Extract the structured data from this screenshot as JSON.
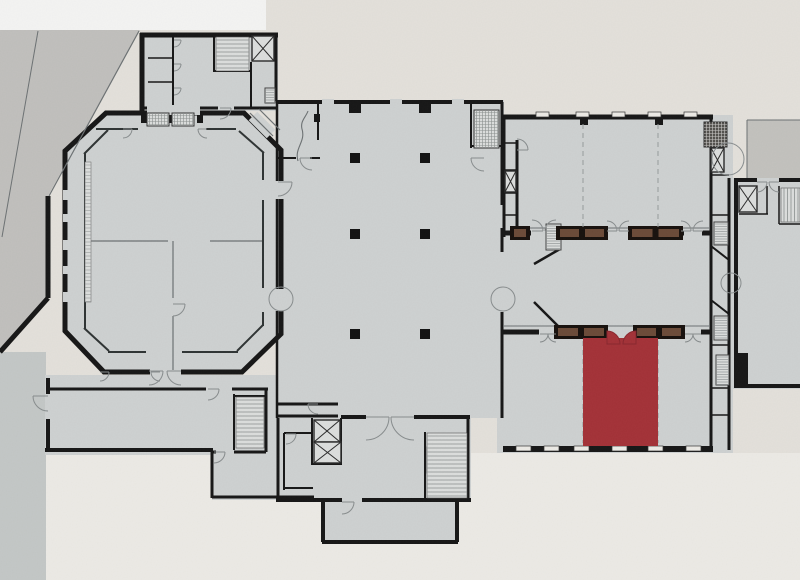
{
  "canvas": {
    "width": 800,
    "height": 580
  },
  "palette": {
    "paper": "#eae7e1",
    "paper_bright": "#f3f1ec",
    "white_strip": "#fbfbfa",
    "pavement": "#c6c5c2",
    "street_strip": "#c9cdcc",
    "terrace": "#c8c7c3",
    "floor": "#d4d7d7",
    "floor_light": "#e2e4e3",
    "wall": "#161616",
    "inner_wall": "#2f3434",
    "line": "#6f7476",
    "door_arc": "#8b9091",
    "hatch_line": "#8e9392",
    "dashed_line": "#9aa0a0",
    "highlight": "#a83238",
    "highlight_dark": "#8c272e",
    "casework_brown": "#6e4c39",
    "casework_black": "#17100c",
    "column": "#111111"
  },
  "plan": {
    "type": "floor-plan",
    "highlighted_room": {
      "label": "selected-gallery",
      "x": 583,
      "y": 338,
      "w": 75,
      "h": 108
    },
    "columns": {
      "xs": [
        355,
        425
      ],
      "ys": [
        158,
        234,
        334
      ],
      "size": 10
    },
    "stairs": [
      {
        "x": 216,
        "y": 37,
        "w": 33,
        "h": 34,
        "dir": "h"
      },
      {
        "x": 236,
        "y": 397,
        "w": 28,
        "h": 51,
        "dir": "h"
      },
      {
        "x": 427,
        "y": 433,
        "w": 40,
        "h": 65,
        "dir": "h"
      },
      {
        "x": 781,
        "y": 188,
        "w": 19,
        "h": 34,
        "dir": "v"
      }
    ],
    "grids": [
      {
        "x": 474,
        "y": 110,
        "w": 25,
        "h": 38,
        "dark": false
      },
      {
        "x": 704,
        "y": 122,
        "w": 23,
        "h": 25,
        "dark": true
      },
      {
        "x": 147,
        "y": 113,
        "w": 22,
        "h": 13,
        "dark": false
      },
      {
        "x": 172,
        "y": 113,
        "w": 22,
        "h": 13,
        "dark": false
      }
    ],
    "vents": [
      {
        "x": 546,
        "y": 224,
        "w": 15,
        "h": 26
      },
      {
        "x": 714,
        "y": 222,
        "w": 14,
        "h": 23
      },
      {
        "x": 714,
        "y": 316,
        "w": 14,
        "h": 24
      },
      {
        "x": 716,
        "y": 355,
        "w": 13,
        "h": 30
      },
      {
        "x": 265,
        "y": 88,
        "w": 10,
        "h": 15
      }
    ],
    "elevators": [
      {
        "x": 252,
        "y": 36,
        "w": 22,
        "h": 25
      },
      {
        "x": 314,
        "y": 420,
        "w": 26,
        "h": 22
      },
      {
        "x": 314,
        "y": 442,
        "w": 27,
        "h": 21
      },
      {
        "x": 505,
        "y": 171,
        "w": 11,
        "h": 21
      },
      {
        "x": 711,
        "y": 148,
        "w": 13,
        "h": 24
      },
      {
        "x": 739,
        "y": 186,
        "w": 18,
        "h": 26
      }
    ],
    "caseworks": [
      {
        "x": 512,
        "y": 227,
        "w": 16,
        "h": 12
      },
      {
        "x": 558,
        "y": 227,
        "w": 48,
        "h": 12
      },
      {
        "x": 630,
        "y": 227,
        "w": 51,
        "h": 12
      },
      {
        "x": 556,
        "y": 326,
        "w": 50,
        "h": 12
      },
      {
        "x": 635,
        "y": 326,
        "w": 48,
        "h": 12
      }
    ],
    "windows_top": {
      "y": 112,
      "w": 13,
      "h": 5,
      "xs": [
        536,
        576,
        612,
        648,
        684
      ]
    },
    "windows_bottom": {
      "y": 446,
      "w": 15,
      "h": 5,
      "xs": [
        516,
        544,
        574,
        612,
        648,
        686
      ]
    },
    "dashed_partitions": [
      {
        "x": 583,
        "y1": 124,
        "y2": 227
      },
      {
        "x": 658,
        "y1": 124,
        "y2": 227
      },
      {
        "x": 583,
        "y1": 341,
        "y2": 443
      },
      {
        "x": 658,
        "y1": 341,
        "y2": 443
      }
    ],
    "doors": [
      {
        "x": 174,
        "y": 40,
        "r": 7,
        "m": ""
      },
      {
        "x": 174,
        "y": 64,
        "r": 7,
        "m": ""
      },
      {
        "x": 174,
        "y": 88,
        "r": 7,
        "m": ""
      },
      {
        "x": 220,
        "y": 108,
        "r": 11,
        "m": ""
      },
      {
        "x": 312,
        "y": 158,
        "r": 12,
        "m": "x"
      },
      {
        "x": 484,
        "y": 158,
        "r": 13,
        "m": "x"
      },
      {
        "x": 278,
        "y": 182,
        "r": 14,
        "m": ""
      },
      {
        "x": 318,
        "y": 404,
        "r": 10,
        "m": "x"
      },
      {
        "x": 532,
        "y": 231,
        "r": 11,
        "m": "y"
      },
      {
        "x": 556,
        "y": 231,
        "r": 11,
        "m": "xy"
      },
      {
        "x": 607,
        "y": 231,
        "r": 10,
        "m": "y"
      },
      {
        "x": 629,
        "y": 231,
        "r": 10,
        "m": "xy"
      },
      {
        "x": 681,
        "y": 231,
        "r": 10,
        "m": "y"
      },
      {
        "x": 703,
        "y": 231,
        "r": 10,
        "m": "xy"
      },
      {
        "x": 540,
        "y": 334,
        "r": 8,
        "m": ""
      },
      {
        "x": 556,
        "y": 334,
        "r": 8,
        "m": "x"
      },
      {
        "x": 685,
        "y": 334,
        "r": 8,
        "m": ""
      },
      {
        "x": 701,
        "y": 334,
        "r": 8,
        "m": "x"
      },
      {
        "x": 208,
        "y": 389,
        "r": 11,
        "m": ""
      },
      {
        "x": 48,
        "y": 396,
        "r": 15,
        "m": "x"
      },
      {
        "x": 100,
        "y": 372,
        "r": 9,
        "m": ""
      },
      {
        "x": 160,
        "y": 372,
        "r": 9,
        "m": "x"
      },
      {
        "x": 214,
        "y": 452,
        "r": 11,
        "m": ""
      },
      {
        "x": 366,
        "y": 417,
        "r": 23,
        "m": ""
      },
      {
        "x": 414,
        "y": 417,
        "r": 23,
        "m": "x"
      },
      {
        "x": 342,
        "y": 502,
        "r": 12,
        "m": ""
      },
      {
        "x": 286,
        "y": 434,
        "r": 10,
        "m": ""
      },
      {
        "x": 757,
        "y": 182,
        "r": 10,
        "m": ""
      },
      {
        "x": 779,
        "y": 182,
        "r": 10,
        "m": "x"
      },
      {
        "x": 149,
        "y": 371,
        "r": 14,
        "m": ""
      },
      {
        "x": 181,
        "y": 371,
        "r": 14,
        "m": "x"
      },
      {
        "x": 173,
        "y": 304,
        "r": 12,
        "m": ""
      },
      {
        "x": 123,
        "y": 129,
        "r": 9,
        "m": ""
      },
      {
        "x": 207,
        "y": 129,
        "r": 9,
        "m": "x"
      },
      {
        "x": 517,
        "y": 150,
        "r": 11,
        "m": "y"
      }
    ],
    "double_doors": [
      {
        "x": 281,
        "y": 299,
        "r": 12,
        "o": "v"
      },
      {
        "x": 503,
        "y": 299,
        "r": 12,
        "o": "v"
      },
      {
        "x": 731,
        "y": 283,
        "r": 10,
        "o": "v"
      },
      {
        "x": 728,
        "y": 159,
        "r": 16,
        "o": "h"
      }
    ]
  }
}
